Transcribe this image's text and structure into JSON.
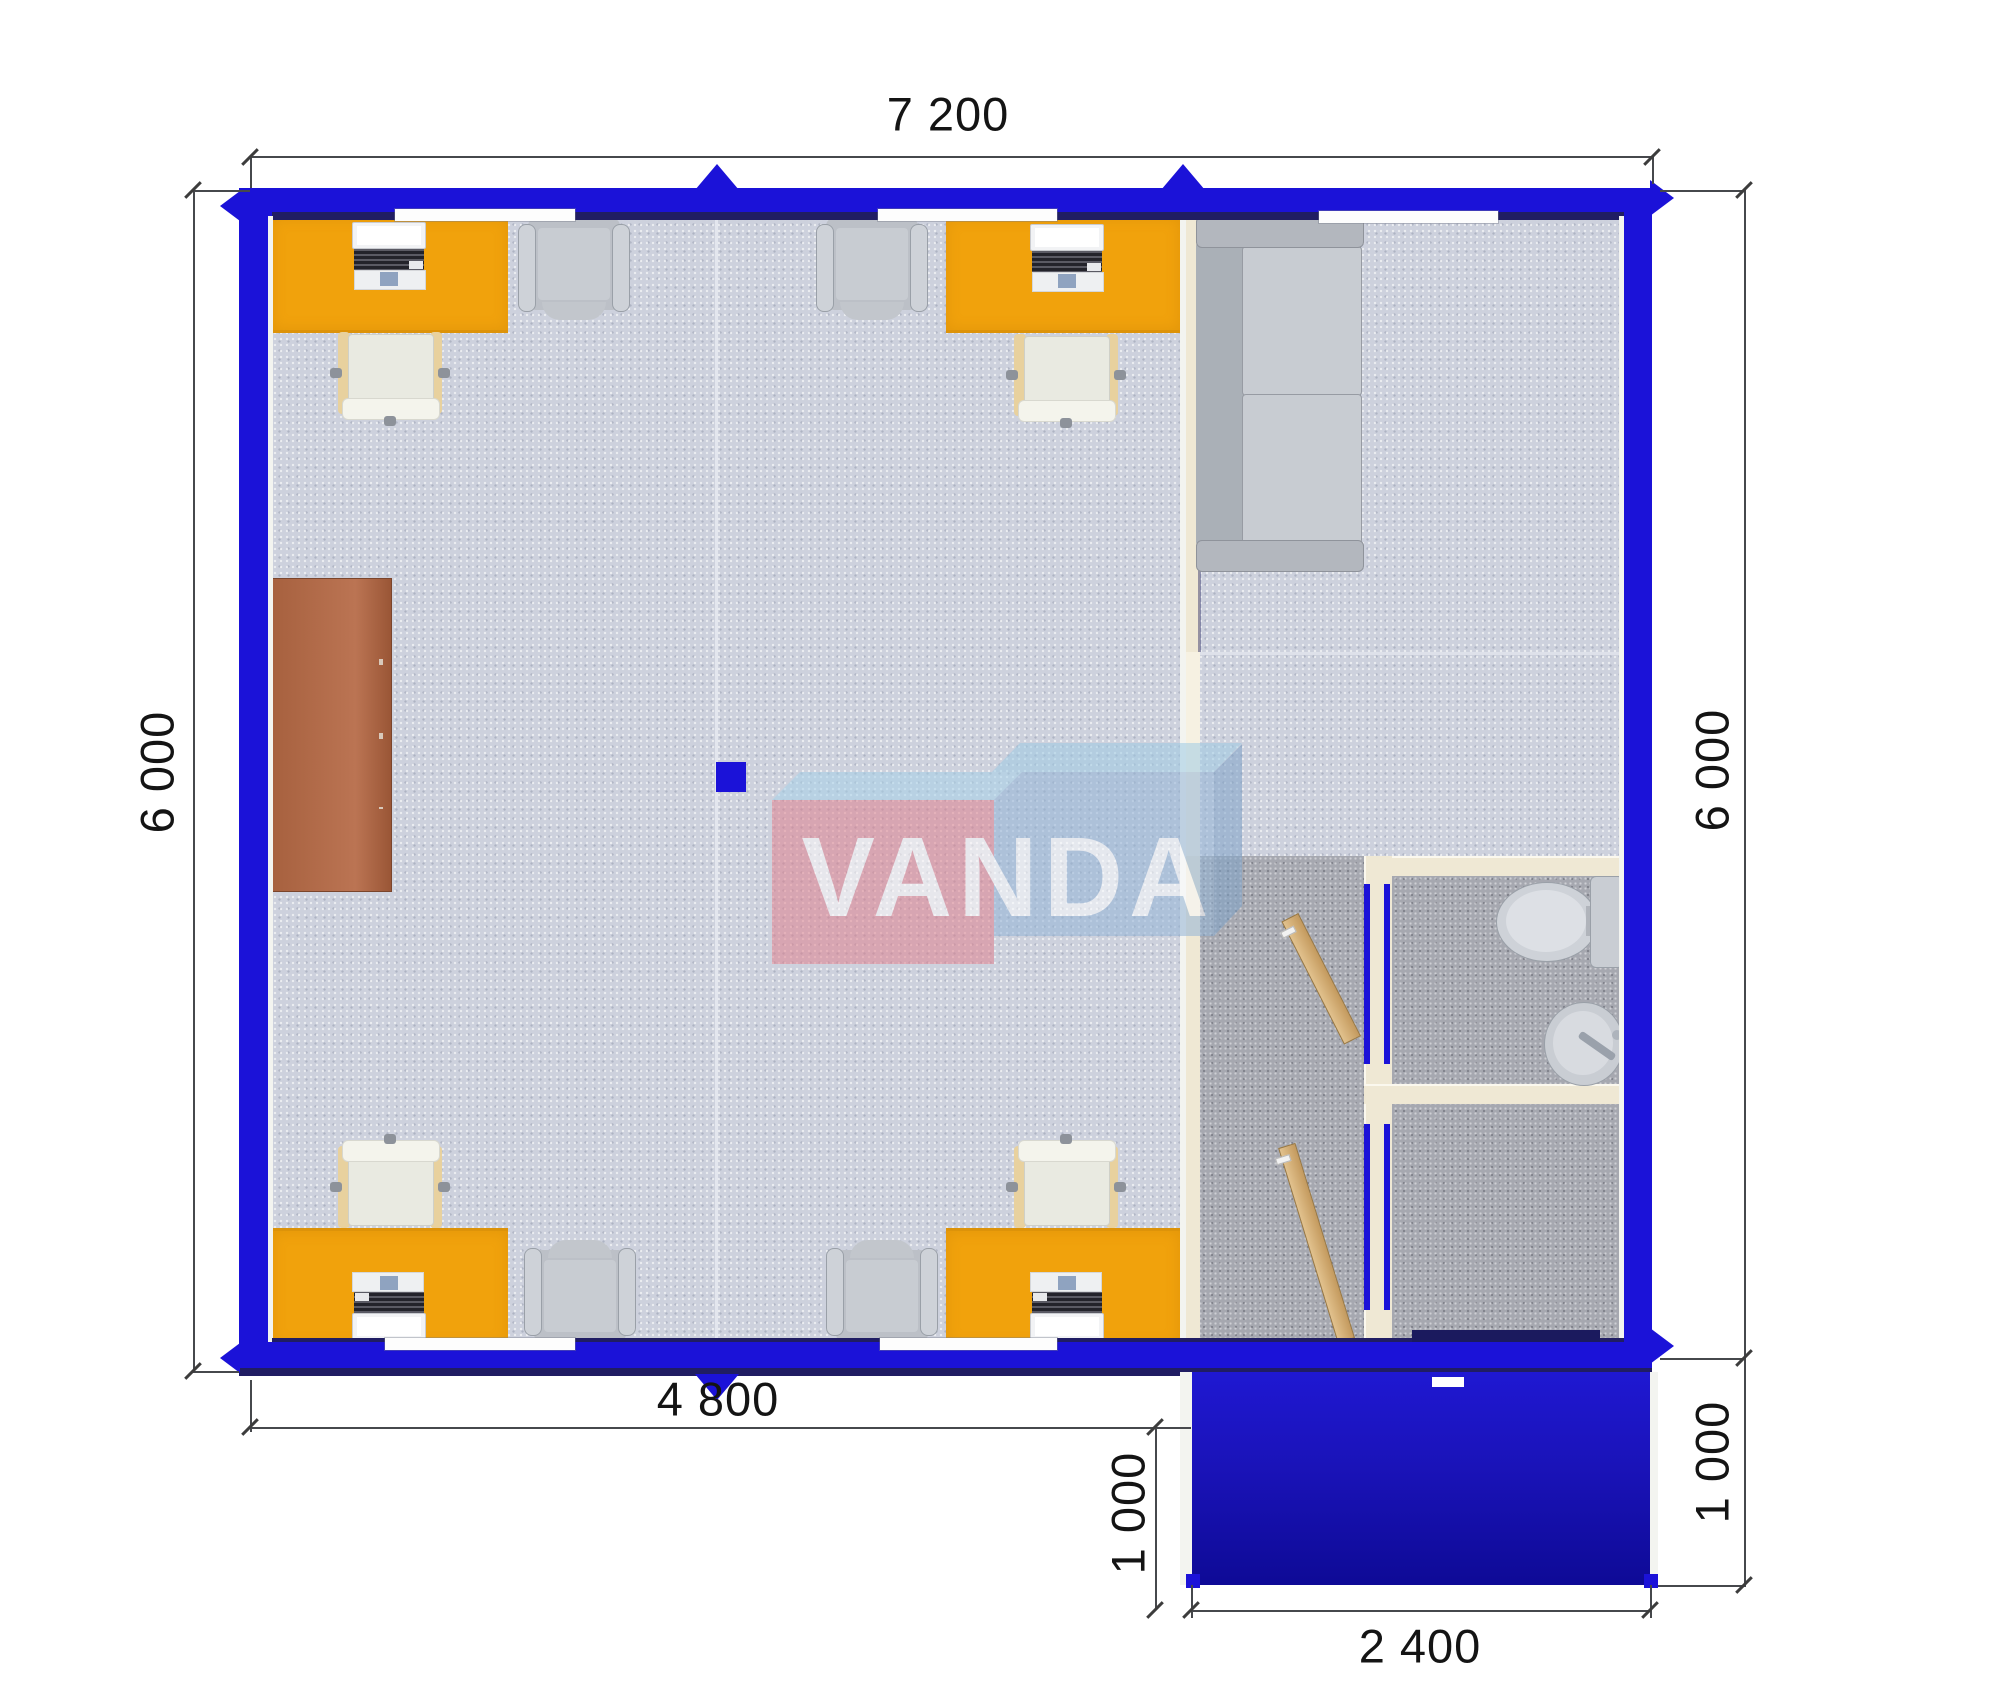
{
  "plan": {
    "brand_watermark": "VANDA",
    "dimensions_mm": {
      "top": "7 200",
      "left": "6 000",
      "right": "6 000",
      "bottom_left": "4 800",
      "porch_left": "1 000",
      "porch_right": "1 000",
      "porch_bottom": "2 400"
    },
    "rooms": {
      "office": {
        "label": "open-plan office",
        "furniture": [
          "orange desk with laptop x4",
          "desk chair x4",
          "visitor armchair x4",
          "brown cabinet",
          "blue floor marker"
        ]
      },
      "lounge": {
        "label": "lounge",
        "furniture": [
          "gray sofa"
        ]
      },
      "hallway": {
        "label": "hallway",
        "furniture": [
          "open wooden door x2"
        ]
      },
      "wc": {
        "label": "WC",
        "furniture": [
          "toilet",
          "wash basin"
        ]
      },
      "porch": {
        "label": "entrance porch",
        "furniture": []
      }
    },
    "colors": {
      "wall_blue": "#1b12d8",
      "wall_navy_shadow": "#201d63",
      "partition_cream": "#efe8d4",
      "carpet_light": "#cdd1dd",
      "carpet_dark": "#a6a8b0",
      "desk_orange": "#f1a20c",
      "cabinet_brown": "#b06a45",
      "sofa_gray": "#bcc0c7",
      "door_wood": "#d7b078",
      "logo_pink": "#e0828f",
      "logo_blue": "#93b4d6",
      "logo_sky": "#9fcbe4"
    }
  }
}
